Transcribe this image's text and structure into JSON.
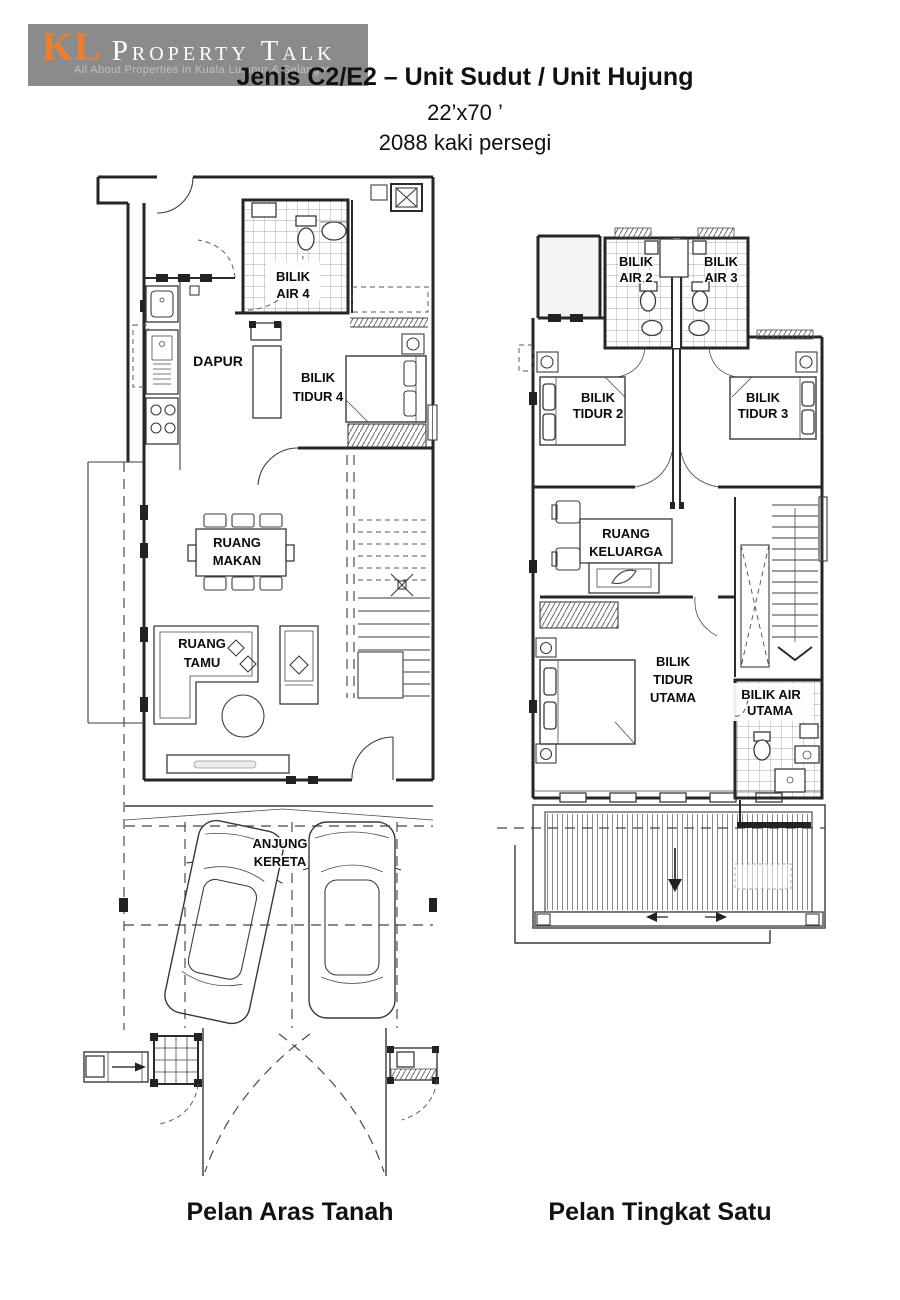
{
  "logo": {
    "prefix": "KL",
    "name": "Property Talk",
    "tagline": "All About Properties in Kuala Lumpur & Selangor",
    "bg_color": "#8b8b8b",
    "prefix_color": "#ee7e2d",
    "name_color": "#ffffff",
    "tagline_color": "#c2c2c2"
  },
  "header": {
    "title": "Jenis C2/E2 – Unit Sudut / Unit Hujung",
    "dimensions": "22’x70 ’",
    "area": "2088 kaki persegi"
  },
  "ground_floor": {
    "caption": "Pelan Aras Tanah",
    "rooms": {
      "bilik_air_4": [
        "BILIK",
        "AIR 4"
      ],
      "dapur": [
        "DAPUR"
      ],
      "bilik_tidur_4": [
        "BILIK",
        "TIDUR 4"
      ],
      "ruang_makan": [
        "RUANG",
        "MAKAN"
      ],
      "ruang_tamu": [
        "RUANG",
        "TAMU"
      ],
      "anjung_kereta": [
        "ANJUNG",
        "KERETA"
      ]
    }
  },
  "first_floor": {
    "caption": "Pelan Tingkat Satu",
    "rooms": {
      "bilik_air_2": [
        "BILIK",
        "AIR 2"
      ],
      "bilik_air_3": [
        "BILIK",
        "AIR 3"
      ],
      "bilik_tidur_2": [
        "BILIK",
        "TIDUR 2"
      ],
      "bilik_tidur_3": [
        "BILIK",
        "TIDUR 3"
      ],
      "ruang_keluarga": [
        "RUANG",
        "KELUARGA"
      ],
      "bilik_tidur_utama": [
        "BILIK",
        "TIDUR",
        "UTAMA"
      ],
      "bilik_air_utama": [
        "BILIK AIR",
        "UTAMA"
      ]
    }
  }
}
